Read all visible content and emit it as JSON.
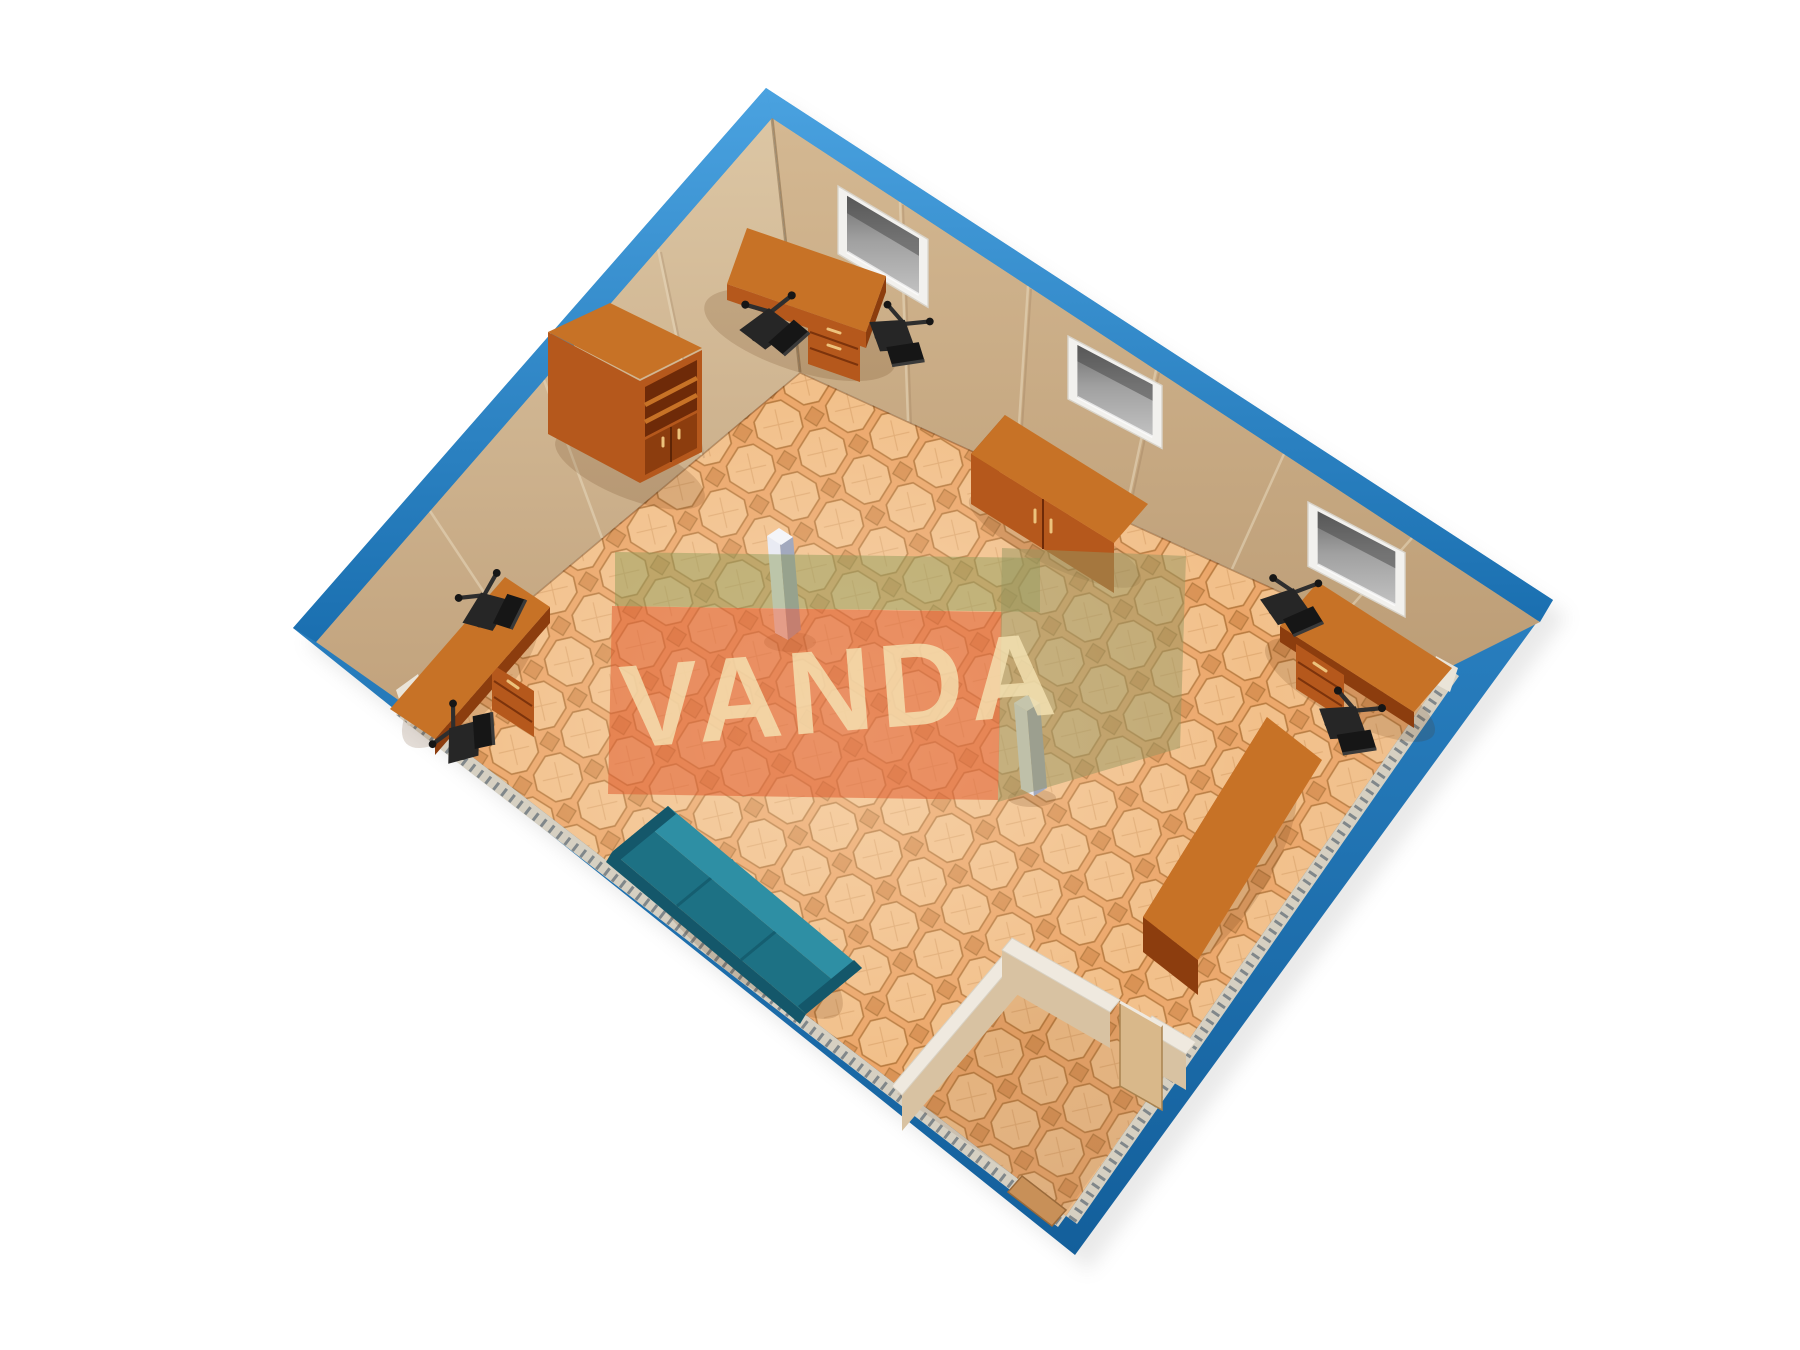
{
  "scene": {
    "type": "3d-floor-plan-render",
    "subject": "Blue office container module, isometric cutaway view from above",
    "watermark": {
      "text": "VANDA"
    },
    "room": {
      "frame": "blue steel container frame",
      "walls": "beige paneled walls, two far walls full height, two near walls cut away",
      "floor": "orange octagon ceramic tile",
      "windows_count": 3,
      "columns_count": 2,
      "entrance": "corner vestibule with open door and threshold"
    },
    "furniture": {
      "desks_count": 4,
      "office_chairs_count": 6,
      "bookcase_count": 1,
      "sideboard_count": 1,
      "sofa_count": 1,
      "sofa_color_name": "teal"
    }
  },
  "colors": {
    "bg": "#ffffff",
    "frame_blue": "#1e7dc2",
    "frame_blue_light": "#3a98dc",
    "frame_blue_dark": "#135f9b",
    "wall": "#cdb28e",
    "wall_dark": "#bfa27e",
    "wall_seam": "#e8d9bd",
    "floor_base": "#eca76a",
    "floor_line": "#b97c40",
    "floor_tile": "#f2c08a",
    "floor_tile_dark": "#d99254",
    "wood": "#b5581c",
    "wood_top": "#c77226",
    "wood_dark": "#8c3d0e",
    "wood_deep": "#6e2a08",
    "chair": "#161616",
    "chair_mid": "#262626",
    "sofa": "#1d7184",
    "sofa_light": "#2e8fa4",
    "sofa_dark": "#14576a",
    "column": "#e9ebf3",
    "column_shade": "#a2a9be",
    "column_cap": "#f4f5f9",
    "window_frame": "#f2f1ee",
    "glass": "#a0a0a0",
    "glass_dark": "#6e6e6e",
    "partition_cap": "#efe9df",
    "partition_face": "#d8c2a2",
    "door": "#d9b88a",
    "threshold": "#c89058",
    "plinth": "#d6d0c2",
    "corrugation": "#3a4a5c",
    "shadow": "#5a2d08",
    "wm_red": "#e05c30",
    "wm_green": "#8c9a58",
    "wm_olive": "#969660",
    "wm_text": "#f6e4b4"
  }
}
